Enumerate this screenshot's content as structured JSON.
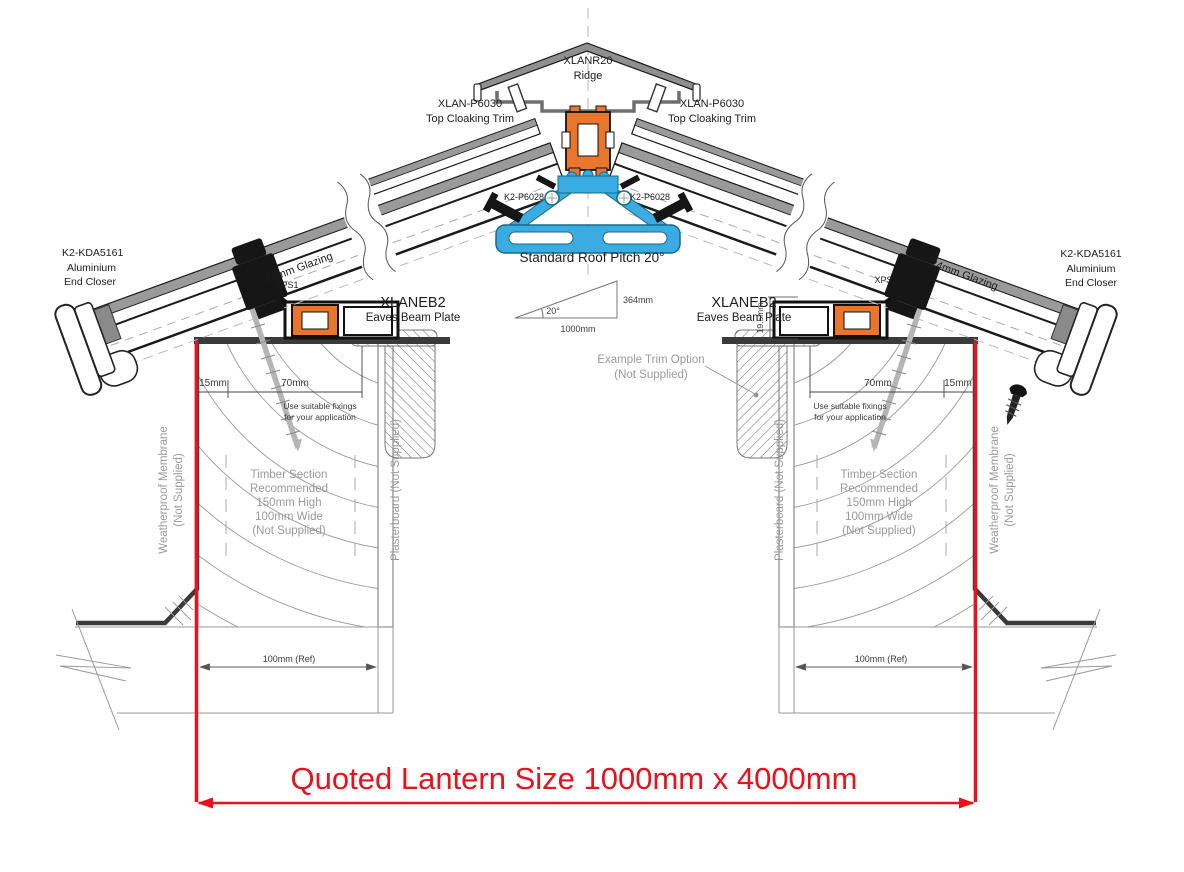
{
  "drawing": {
    "quoted_size": "Quoted Lantern Size 1000mm x 4000mm",
    "ridge": {
      "part": "XLANR20",
      "name": "Ridge"
    },
    "cloaking_trim": {
      "part": "XLAN-P6030",
      "name": "Top Cloaking Trim"
    },
    "ridge_gasket": {
      "part": "K2-P6028"
    },
    "end_closer": {
      "part": "K2-KDA5161",
      "line2": "Aluminium",
      "line3": "End Closer"
    },
    "glazing": {
      "label": "24mm Glazing"
    },
    "xps": {
      "label": "XPS1"
    },
    "eaves_beam": {
      "part": "XLANEB2",
      "name": "Eaves Beam Plate"
    },
    "pitch": {
      "label": "Standard Roof Pitch 20°",
      "angle": "20°",
      "run": "1000mm",
      "rise": "364mm"
    },
    "dims": {
      "d15": "15mm",
      "d70": "70mm",
      "d19_5": "19.5mm",
      "d100ref": "100mm (Ref)"
    },
    "notes": {
      "fixings_line1": "Use suitable fixings",
      "fixings_line2": "for your application",
      "timber": [
        "Timber Section",
        "Recommended",
        "150mm High",
        "100mm Wide",
        "(Not Supplied)"
      ],
      "membrane_line1": "Weatherproof Membrane",
      "membrane_line2": "(Not Supplied)",
      "plasterboard": "Plasterboard (Not Supplied)",
      "trim_option_line1": "Example  Trim Option",
      "trim_option_line2": "(Not Supplied)"
    },
    "colors": {
      "accent_red": "#e8121c",
      "profile_orange": "#e8762c",
      "profile_blue": "#3aace1"
    }
  }
}
